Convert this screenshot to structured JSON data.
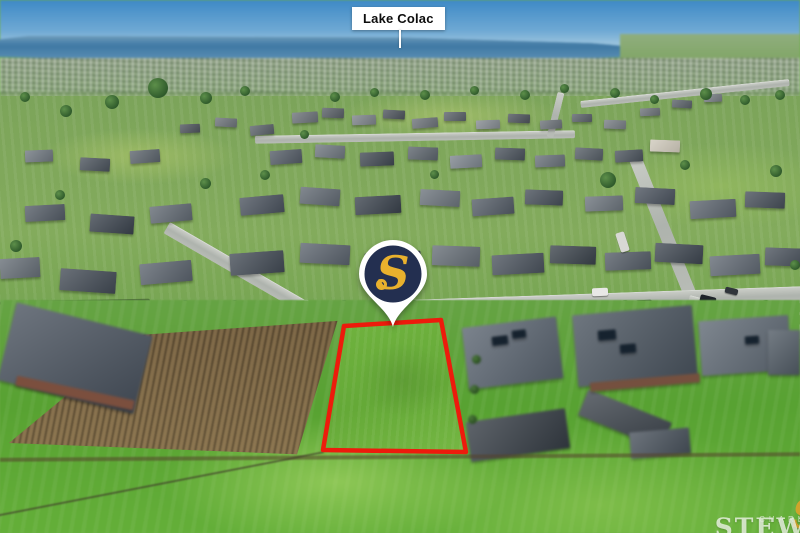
{
  "labels": {
    "lake": "Lake Colac"
  },
  "pin": {
    "monogram": "S",
    "colors": {
      "navy": "#232f50",
      "gold": "#e9b12d",
      "white": "#ffffff"
    }
  },
  "boundary": {
    "stroke": "#ed1b0c"
  },
  "watermark": {
    "monogram": "S",
    "line1": "CHARLES",
    "line2": "STEWART",
    "gold": "#d8a42b"
  }
}
